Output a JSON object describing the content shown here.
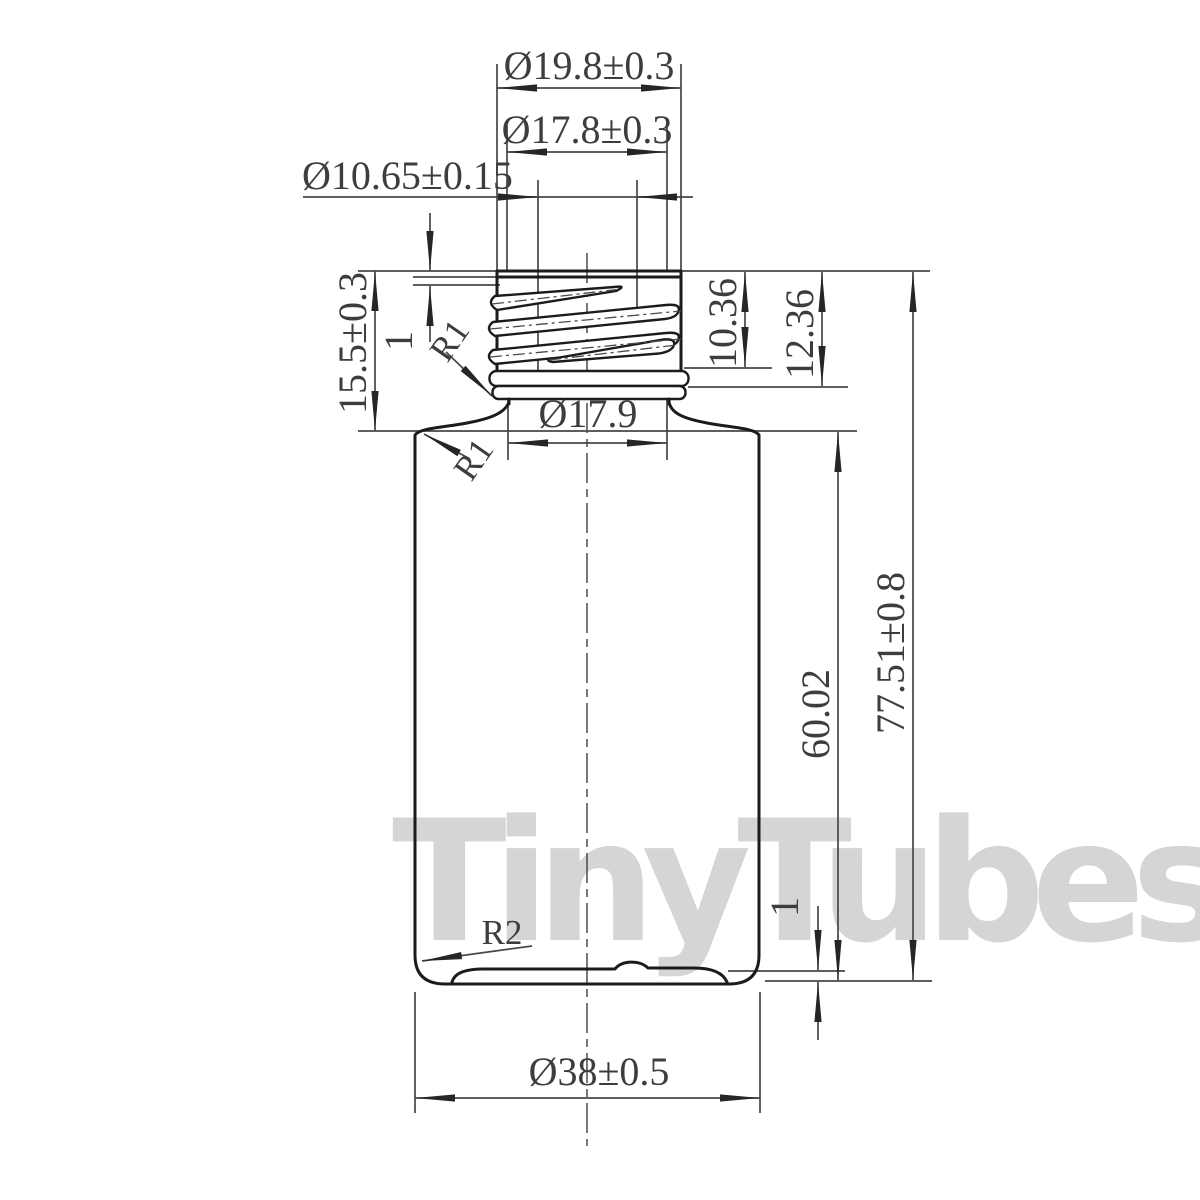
{
  "watermark": {
    "text": "TinyTubes",
    "color": "#d5d5d5"
  },
  "labels": {
    "neck_outer_dia": "Ø19.8±0.3",
    "thread_outer_dia": "Ø17.8±0.3",
    "mouth_inner_dia": "Ø10.65±0.15",
    "neck_height": "15.5±0.3",
    "rim_offset": "1",
    "neck_radius": "R1",
    "shoulder_radius": "R1",
    "neck_lower_dia": "Ø17.9",
    "thread_length": "10.36",
    "bead_height": "12.36",
    "body_height": "60.02",
    "total_height": "77.51±0.8",
    "base_inset": "1",
    "base_radius": "R2",
    "body_dia": "Ø38±0.5"
  },
  "colors": {
    "background": "#ffffff",
    "outline": "#1b1b1b",
    "dimension_lines": "#474747",
    "dimension_text": "#3d3d3d",
    "watermark": "#d5d5d5"
  }
}
